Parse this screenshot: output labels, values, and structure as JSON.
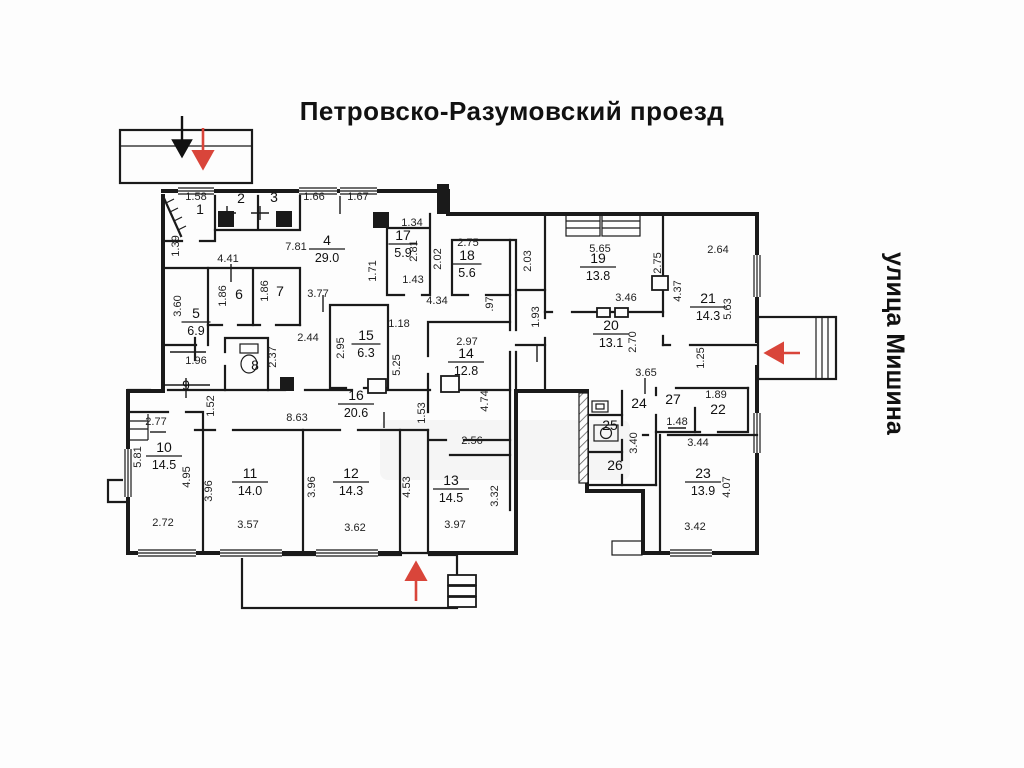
{
  "streets": {
    "top": "Петровско-Разумовский проезд",
    "right": "улица Мишина"
  },
  "colors": {
    "wall": "#1a1a1a",
    "arrow_red": "#d9453a",
    "arrow_black": "#111111",
    "background": "#fdfdfd"
  },
  "rooms": [
    {
      "num": "1",
      "area": null,
      "x": 200,
      "y": 214
    },
    {
      "num": "2",
      "area": null,
      "x": 241,
      "y": 203
    },
    {
      "num": "3",
      "area": null,
      "x": 274,
      "y": 202
    },
    {
      "num": "4",
      "area": "29.0",
      "x": 327,
      "y": 245
    },
    {
      "num": "5",
      "area": "6.9",
      "x": 196,
      "y": 318
    },
    {
      "num": "6",
      "area": null,
      "x": 239,
      "y": 299
    },
    {
      "num": "7",
      "area": null,
      "x": 280,
      "y": 296
    },
    {
      "num": "8",
      "area": null,
      "x": 255,
      "y": 370
    },
    {
      "num": "9",
      "area": null,
      "x": 186,
      "y": 390
    },
    {
      "num": "10",
      "area": "14.5",
      "x": 164,
      "y": 452
    },
    {
      "num": "11",
      "area": "14.0",
      "x": 250,
      "y": 478
    },
    {
      "num": "12",
      "area": "14.3",
      "x": 351,
      "y": 478
    },
    {
      "num": "13",
      "area": "14.5",
      "x": 451,
      "y": 485
    },
    {
      "num": "14",
      "area": "12.8",
      "x": 466,
      "y": 358
    },
    {
      "num": "15",
      "area": "6.3",
      "x": 366,
      "y": 340
    },
    {
      "num": "16",
      "area": "20.6",
      "x": 356,
      "y": 400
    },
    {
      "num": "17",
      "area": "5.9",
      "x": 403,
      "y": 240
    },
    {
      "num": "18",
      "area": "5.6",
      "x": 467,
      "y": 260
    },
    {
      "num": "19",
      "area": "13.8",
      "x": 598,
      "y": 263
    },
    {
      "num": "20",
      "area": "13.1",
      "x": 611,
      "y": 330
    },
    {
      "num": "21",
      "area": "14.3",
      "x": 708,
      "y": 303
    },
    {
      "num": "22",
      "area": null,
      "x": 718,
      "y": 414
    },
    {
      "num": "23",
      "area": "13.9",
      "x": 703,
      "y": 478
    },
    {
      "num": "24",
      "area": null,
      "x": 639,
      "y": 408
    },
    {
      "num": "25",
      "area": null,
      "x": 610,
      "y": 430
    },
    {
      "num": "26",
      "area": null,
      "x": 615,
      "y": 470
    },
    {
      "num": "27",
      "area": null,
      "x": 673,
      "y": 404
    }
  ],
  "dims": [
    {
      "t": "1.58",
      "x": 196,
      "y": 200,
      "r": 0
    },
    {
      "t": "1.66",
      "x": 314,
      "y": 200,
      "r": 0
    },
    {
      "t": "1.67",
      "x": 358,
      "y": 200,
      "r": 0
    },
    {
      "t": "1.34",
      "x": 412,
      "y": 226,
      "r": 0
    },
    {
      "t": "4.41",
      "x": 228,
      "y": 262,
      "r": 0
    },
    {
      "t": "7.81",
      "x": 296,
      "y": 250,
      "r": 0
    },
    {
      "t": "3.77",
      "x": 318,
      "y": 297,
      "r": 0
    },
    {
      "t": "2.44",
      "x": 308,
      "y": 341,
      "r": 0
    },
    {
      "t": "2.75",
      "x": 468,
      "y": 246,
      "r": 0
    },
    {
      "t": "5.65",
      "x": 600,
      "y": 252,
      "r": 0
    },
    {
      "t": "2.64",
      "x": 718,
      "y": 253,
      "r": 0
    },
    {
      "t": "3.46",
      "x": 626,
      "y": 301,
      "r": 0
    },
    {
      "t": "1.43",
      "x": 413,
      "y": 283,
      "r": 0
    },
    {
      "t": "4.34",
      "x": 437,
      "y": 304,
      "r": 0
    },
    {
      "t": "1.18",
      "x": 399,
      "y": 327,
      "r": 0
    },
    {
      "t": "2.97",
      "x": 467,
      "y": 345,
      "r": 0
    },
    {
      "t": "3.65",
      "x": 646,
      "y": 376,
      "r": 0
    },
    {
      "t": "1.89",
      "x": 716,
      "y": 398,
      "r": 0
    },
    {
      "t": "1.48",
      "x": 677,
      "y": 425,
      "r": 0
    },
    {
      "t": "3.44",
      "x": 698,
      "y": 446,
      "r": 0
    },
    {
      "t": "1.96",
      "x": 196,
      "y": 364,
      "r": 0
    },
    {
      "t": "2.77",
      "x": 156,
      "y": 425,
      "r": 0
    },
    {
      "t": "8.63",
      "x": 297,
      "y": 421,
      "r": 0
    },
    {
      "t": "2.56",
      "x": 472,
      "y": 444,
      "r": 0
    },
    {
      "t": "2.72",
      "x": 163,
      "y": 526,
      "r": 0
    },
    {
      "t": "3.57",
      "x": 248,
      "y": 528,
      "r": 0
    },
    {
      "t": "3.62",
      "x": 355,
      "y": 531,
      "r": 0
    },
    {
      "t": "3.97",
      "x": 455,
      "y": 528,
      "r": 0
    },
    {
      "t": "3.42",
      "x": 695,
      "y": 530,
      "r": 0
    },
    {
      "t": "1.39",
      "x": 179,
      "y": 246,
      "r": -90
    },
    {
      "t": "3.60",
      "x": 181,
      "y": 306,
      "r": -90
    },
    {
      "t": "1.86",
      "x": 226,
      "y": 296,
      "r": -90
    },
    {
      "t": "1.86",
      "x": 268,
      "y": 291,
      "r": -90
    },
    {
      "t": "1.71",
      "x": 376,
      "y": 271,
      "r": -90
    },
    {
      "t": "2.81",
      "x": 417,
      "y": 251,
      "r": -90
    },
    {
      "t": "2.02",
      "x": 441,
      "y": 259,
      "r": -90
    },
    {
      "t": "2.03",
      "x": 531,
      "y": 261,
      "r": -90
    },
    {
      "t": "2.75",
      "x": 661,
      "y": 263,
      "r": -90
    },
    {
      "t": "4.37",
      "x": 681,
      "y": 291,
      "r": -90
    },
    {
      "t": "5.63",
      "x": 731,
      "y": 309,
      "r": -90
    },
    {
      "t": "2.95",
      "x": 344,
      "y": 348,
      "r": -90
    },
    {
      "t": "5.25",
      "x": 400,
      "y": 365,
      "r": -90
    },
    {
      "t": ".97",
      "x": 493,
      "y": 304,
      "r": -90
    },
    {
      "t": "1.93",
      "x": 539,
      "y": 317,
      "r": -90
    },
    {
      "t": "2.70",
      "x": 636,
      "y": 342,
      "r": -90
    },
    {
      "t": "2.37",
      "x": 276,
      "y": 357,
      "r": -90
    },
    {
      "t": "1.25",
      "x": 704,
      "y": 358,
      "r": -90
    },
    {
      "t": "1.52",
      "x": 214,
      "y": 406,
      "r": -90
    },
    {
      "t": "5.81",
      "x": 141,
      "y": 457,
      "r": -90
    },
    {
      "t": "4.95",
      "x": 190,
      "y": 477,
      "r": -90
    },
    {
      "t": "3.96",
      "x": 212,
      "y": 491,
      "r": -90
    },
    {
      "t": "3.96",
      "x": 315,
      "y": 487,
      "r": -90
    },
    {
      "t": "1.53",
      "x": 425,
      "y": 413,
      "r": -90
    },
    {
      "t": "4.74",
      "x": 488,
      "y": 401,
      "r": -90
    },
    {
      "t": "4.53",
      "x": 410,
      "y": 487,
      "r": -90
    },
    {
      "t": "3.32",
      "x": 498,
      "y": 496,
      "r": -90
    },
    {
      "t": "3.40",
      "x": 637,
      "y": 443,
      "r": -90
    },
    {
      "t": "4.07",
      "x": 730,
      "y": 487,
      "r": -90
    }
  ]
}
